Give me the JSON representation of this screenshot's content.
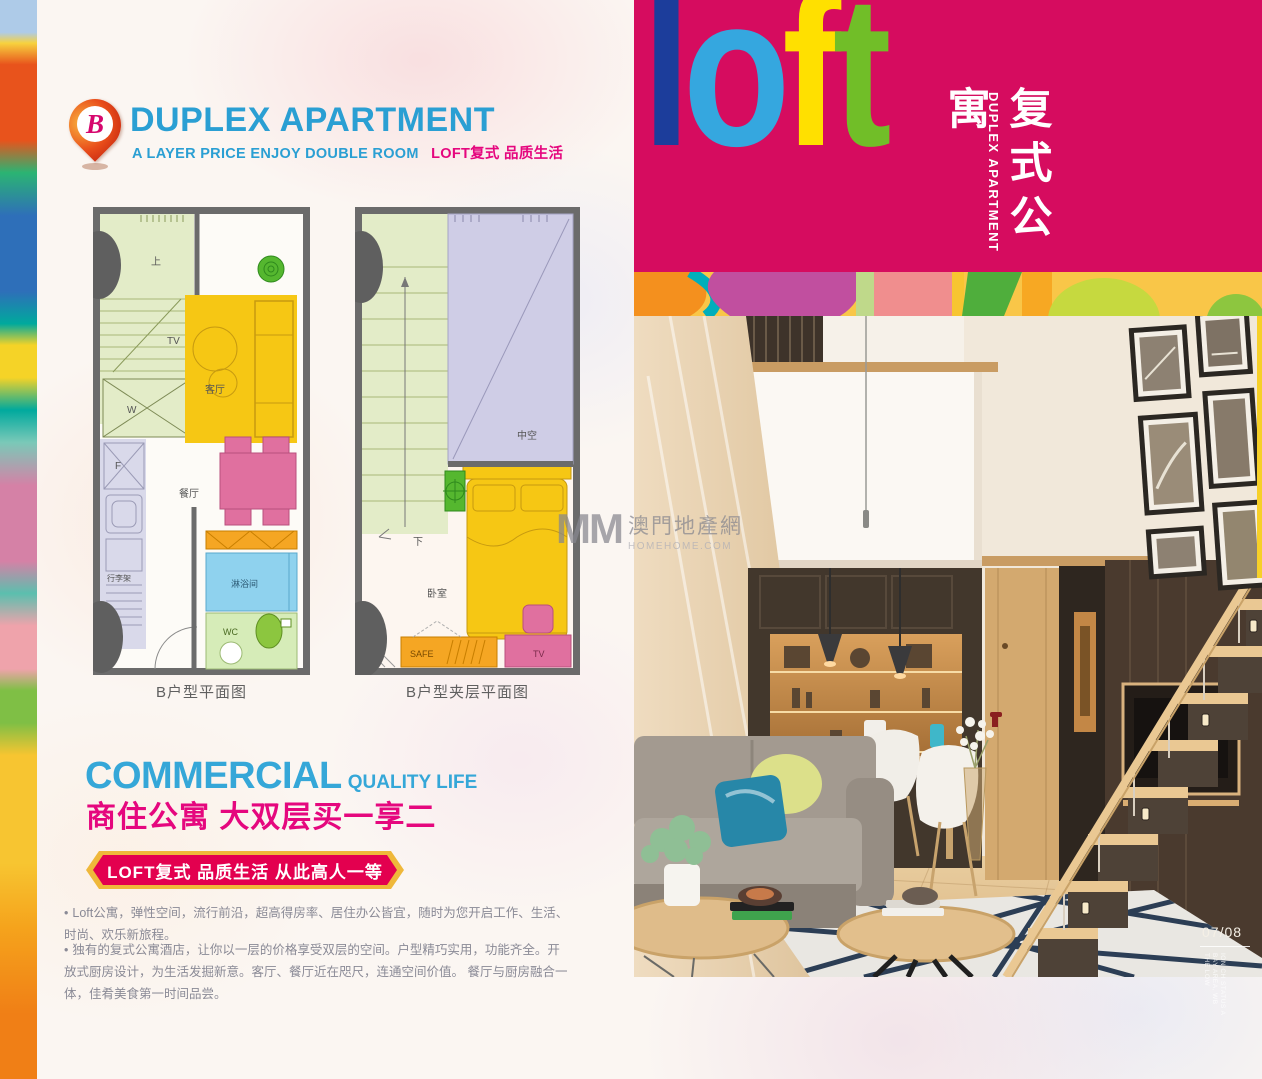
{
  "header": {
    "pin_letter": "B",
    "title": "DUPLEX APARTMENT",
    "subtitle_en": "A LAYER PRICE ENJOY DOUBLE ROOM",
    "subtitle_cn": "LOFT复式 品质生活"
  },
  "floorplans": {
    "plan1": {
      "caption": "B户型平面图",
      "labels": {
        "up": "上",
        "tv": "TV",
        "living": "客厅",
        "dining": "餐厅",
        "wardrobe": "W",
        "fridge": "F",
        "luggage": "行李架",
        "shower": "淋浴间",
        "wc": "WC"
      }
    },
    "plan2": {
      "caption": "B户型夹层平面图",
      "labels": {
        "void": "中空",
        "down": "下",
        "bedroom": "卧室",
        "safe": "SAFE",
        "tv": "TV"
      }
    }
  },
  "commercial": {
    "title_en": "COMMERCIAL",
    "subtitle_en": "QUALITY LIFE",
    "headline_cn": "商住公寓 大双层买一享二",
    "banner": "LOFT复式 品质生活 从此高人一等",
    "bullet_marker": "•",
    "bullet1": "Loft公寓，弹性空间，流行前沿，超高得房率、居住办公皆宜，随时为您开启工作、生活、时尚、欢乐新旅程。",
    "bullet2": "独有的复式公寓酒店，让你以一层的价格享受双层的空间。户型精巧实用，功能齐全。开放式厨房设计，为生活发掘新意。客厅、餐厅近在咫尺，连通空间价值。 餐厅与厨房融合一体，佳肴美食第一时间品尝。"
  },
  "loft_block": {
    "letters": [
      {
        "char": "l",
        "color": "#1C3D9B"
      },
      {
        "char": "o",
        "color": "#35A7DF"
      },
      {
        "char": "f",
        "color": "#FFE000"
      },
      {
        "char": "t",
        "color": "#71BE28"
      }
    ],
    "cn_vertical": "复式公寓",
    "en_vertical": "DUPLEX APARTMENT"
  },
  "watermark": {
    "mm": "MM",
    "cn": "澳門地產網",
    "site": "HOMEHOME.COM"
  },
  "photo": {
    "page_number": "07/08",
    "side_text_lines": [
      "THE LOW",
      "BAY AREA, WB",
      "ION CH STATUS A"
    ]
  },
  "colors": {
    "brand_pink": "#D60C5F",
    "title_blue": "#2A9FD3",
    "accent_magenta": "#E5077E",
    "banner_red": "#E3004F",
    "banner_gold": "#EFB83A"
  }
}
